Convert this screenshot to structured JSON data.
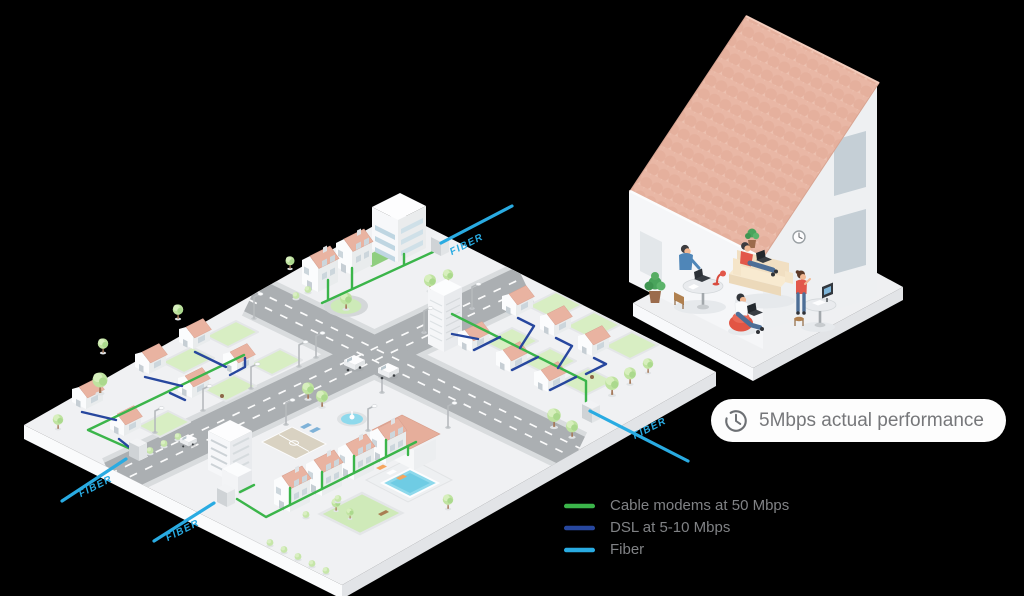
{
  "canvas": {
    "background": "#000000"
  },
  "diagram": {
    "badge": {
      "label": "5Mbps actual performance"
    },
    "legend": [
      {
        "label": "Cable modems at 50 Mbps",
        "color": "#3bb54a"
      },
      {
        "label": "DSL at 5-10 Mbps",
        "color": "#27479e"
      },
      {
        "label": "Fiber",
        "color": "#29abe2"
      }
    ],
    "fiber_labels": {
      "top": "FIBER",
      "right": "FIBER",
      "bottom_left": "FIBER",
      "bottom_center": "FIBER"
    }
  }
}
